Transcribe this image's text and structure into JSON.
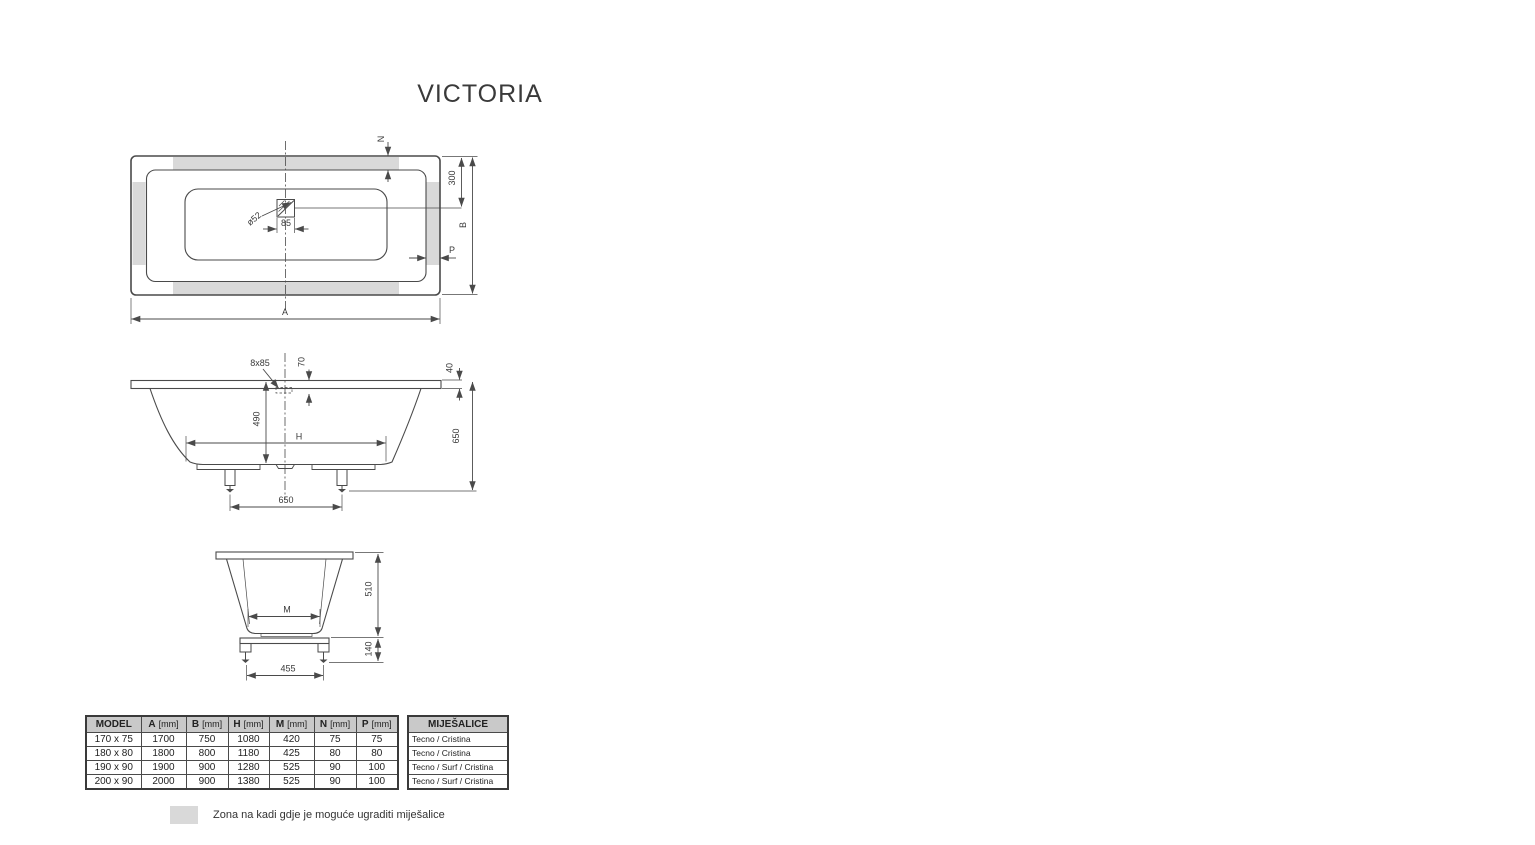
{
  "title": "VICTORIA",
  "top_view": {
    "dim_n": "N",
    "dim_300": "300",
    "dim_b": "B",
    "dim_p": "P",
    "dim_a": "A",
    "dim_85": "85",
    "hole_label": "ø52"
  },
  "side_view": {
    "hole_label": "8x85",
    "dim_70": "70",
    "dim_490": "490",
    "dim_h": "H",
    "dim_650_feet": "650",
    "dim_40": "40",
    "dim_650_height": "650"
  },
  "end_view": {
    "dim_m": "M",
    "dim_510": "510",
    "dim_140": "140",
    "dim_455": "455"
  },
  "table": {
    "headers": [
      {
        "label": "MODEL",
        "unit": ""
      },
      {
        "label": "A",
        "unit": "[mm]"
      },
      {
        "label": "B",
        "unit": "[mm]"
      },
      {
        "label": "H",
        "unit": "[mm]"
      },
      {
        "label": "M",
        "unit": "[mm]"
      },
      {
        "label": "N",
        "unit": "[mm]"
      },
      {
        "label": "P",
        "unit": "[mm]"
      }
    ],
    "rows": [
      [
        "170 x 75",
        "1700",
        "750",
        "1080",
        "420",
        "75",
        "75"
      ],
      [
        "180 x 80",
        "1800",
        "800",
        "1180",
        "425",
        "80",
        "80"
      ],
      [
        "190 x 90",
        "1900",
        "900",
        "1280",
        "525",
        "90",
        "100"
      ],
      [
        "200 x 90",
        "2000",
        "900",
        "1380",
        "525",
        "90",
        "100"
      ]
    ],
    "mixers_header": "MIJEŠALICE",
    "mixers_rows": [
      "Tecno / Cristina",
      "Tecno / Cristina",
      "Tecno / Surf / Cristina",
      "Tecno / Surf / Cristina"
    ]
  },
  "legend": {
    "text": "Zona na kadi gdje je moguće ugraditi miješalice"
  },
  "colors": {
    "line": "#4a4a4a",
    "zone": "#d9d9d9",
    "text": "#3a3a3a",
    "header_bg": "#c9c9c9"
  }
}
